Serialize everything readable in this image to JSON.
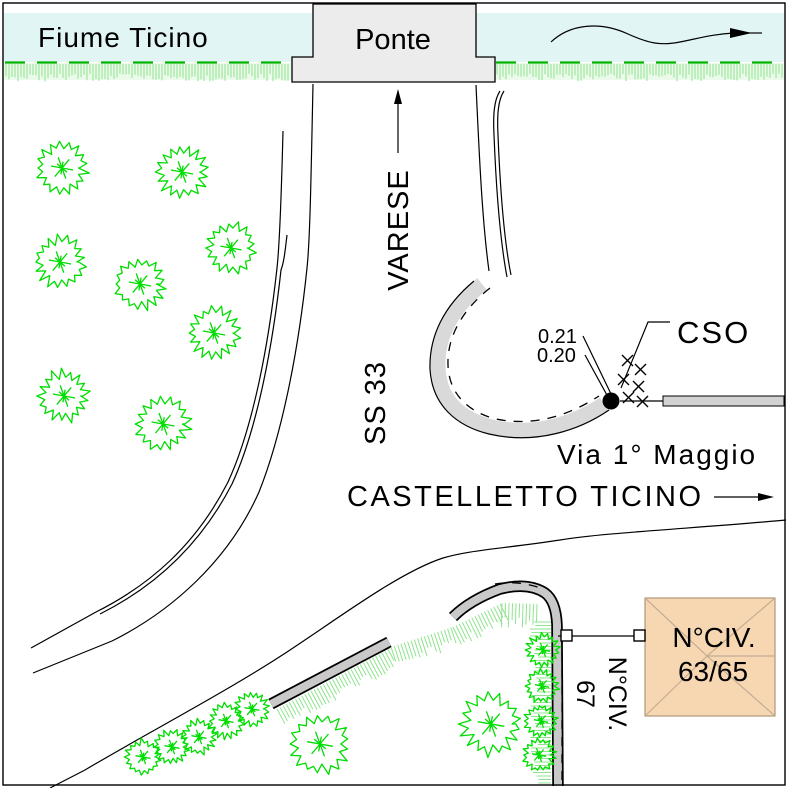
{
  "drawing": {
    "type": "cadastral-site-plan",
    "labels": {
      "river": "Fiume Ticino",
      "bridge": "Ponte",
      "direction_sign": "VARESE",
      "highway": "SS 33",
      "town": "CASTELLETTO TICINO",
      "street": "Via 1° Maggio",
      "point_code": "CSO",
      "elevation_1": "0.21",
      "elevation_2": "0.20",
      "building_label_line1": "N°CIV.",
      "building_label_line2": "63/65",
      "adjacent_building_label": "N°CIV.",
      "adjacent_building_number": "67"
    },
    "colors": {
      "river": "#e2f5f5",
      "vegetation": "#00dd00",
      "bank_dash": "#00b400",
      "grass_hatch": "#8ee48e",
      "grass_band": "#ebfaeb",
      "road_fill": "#d9d9d9",
      "bridge_fill": "#ececec",
      "wall_gray": "#c9c9c9",
      "bar_gray": "#d2d2d2",
      "building_fill": "#f6d7b2",
      "roof_line": "#c3ad92",
      "ink": "#000000"
    }
  }
}
